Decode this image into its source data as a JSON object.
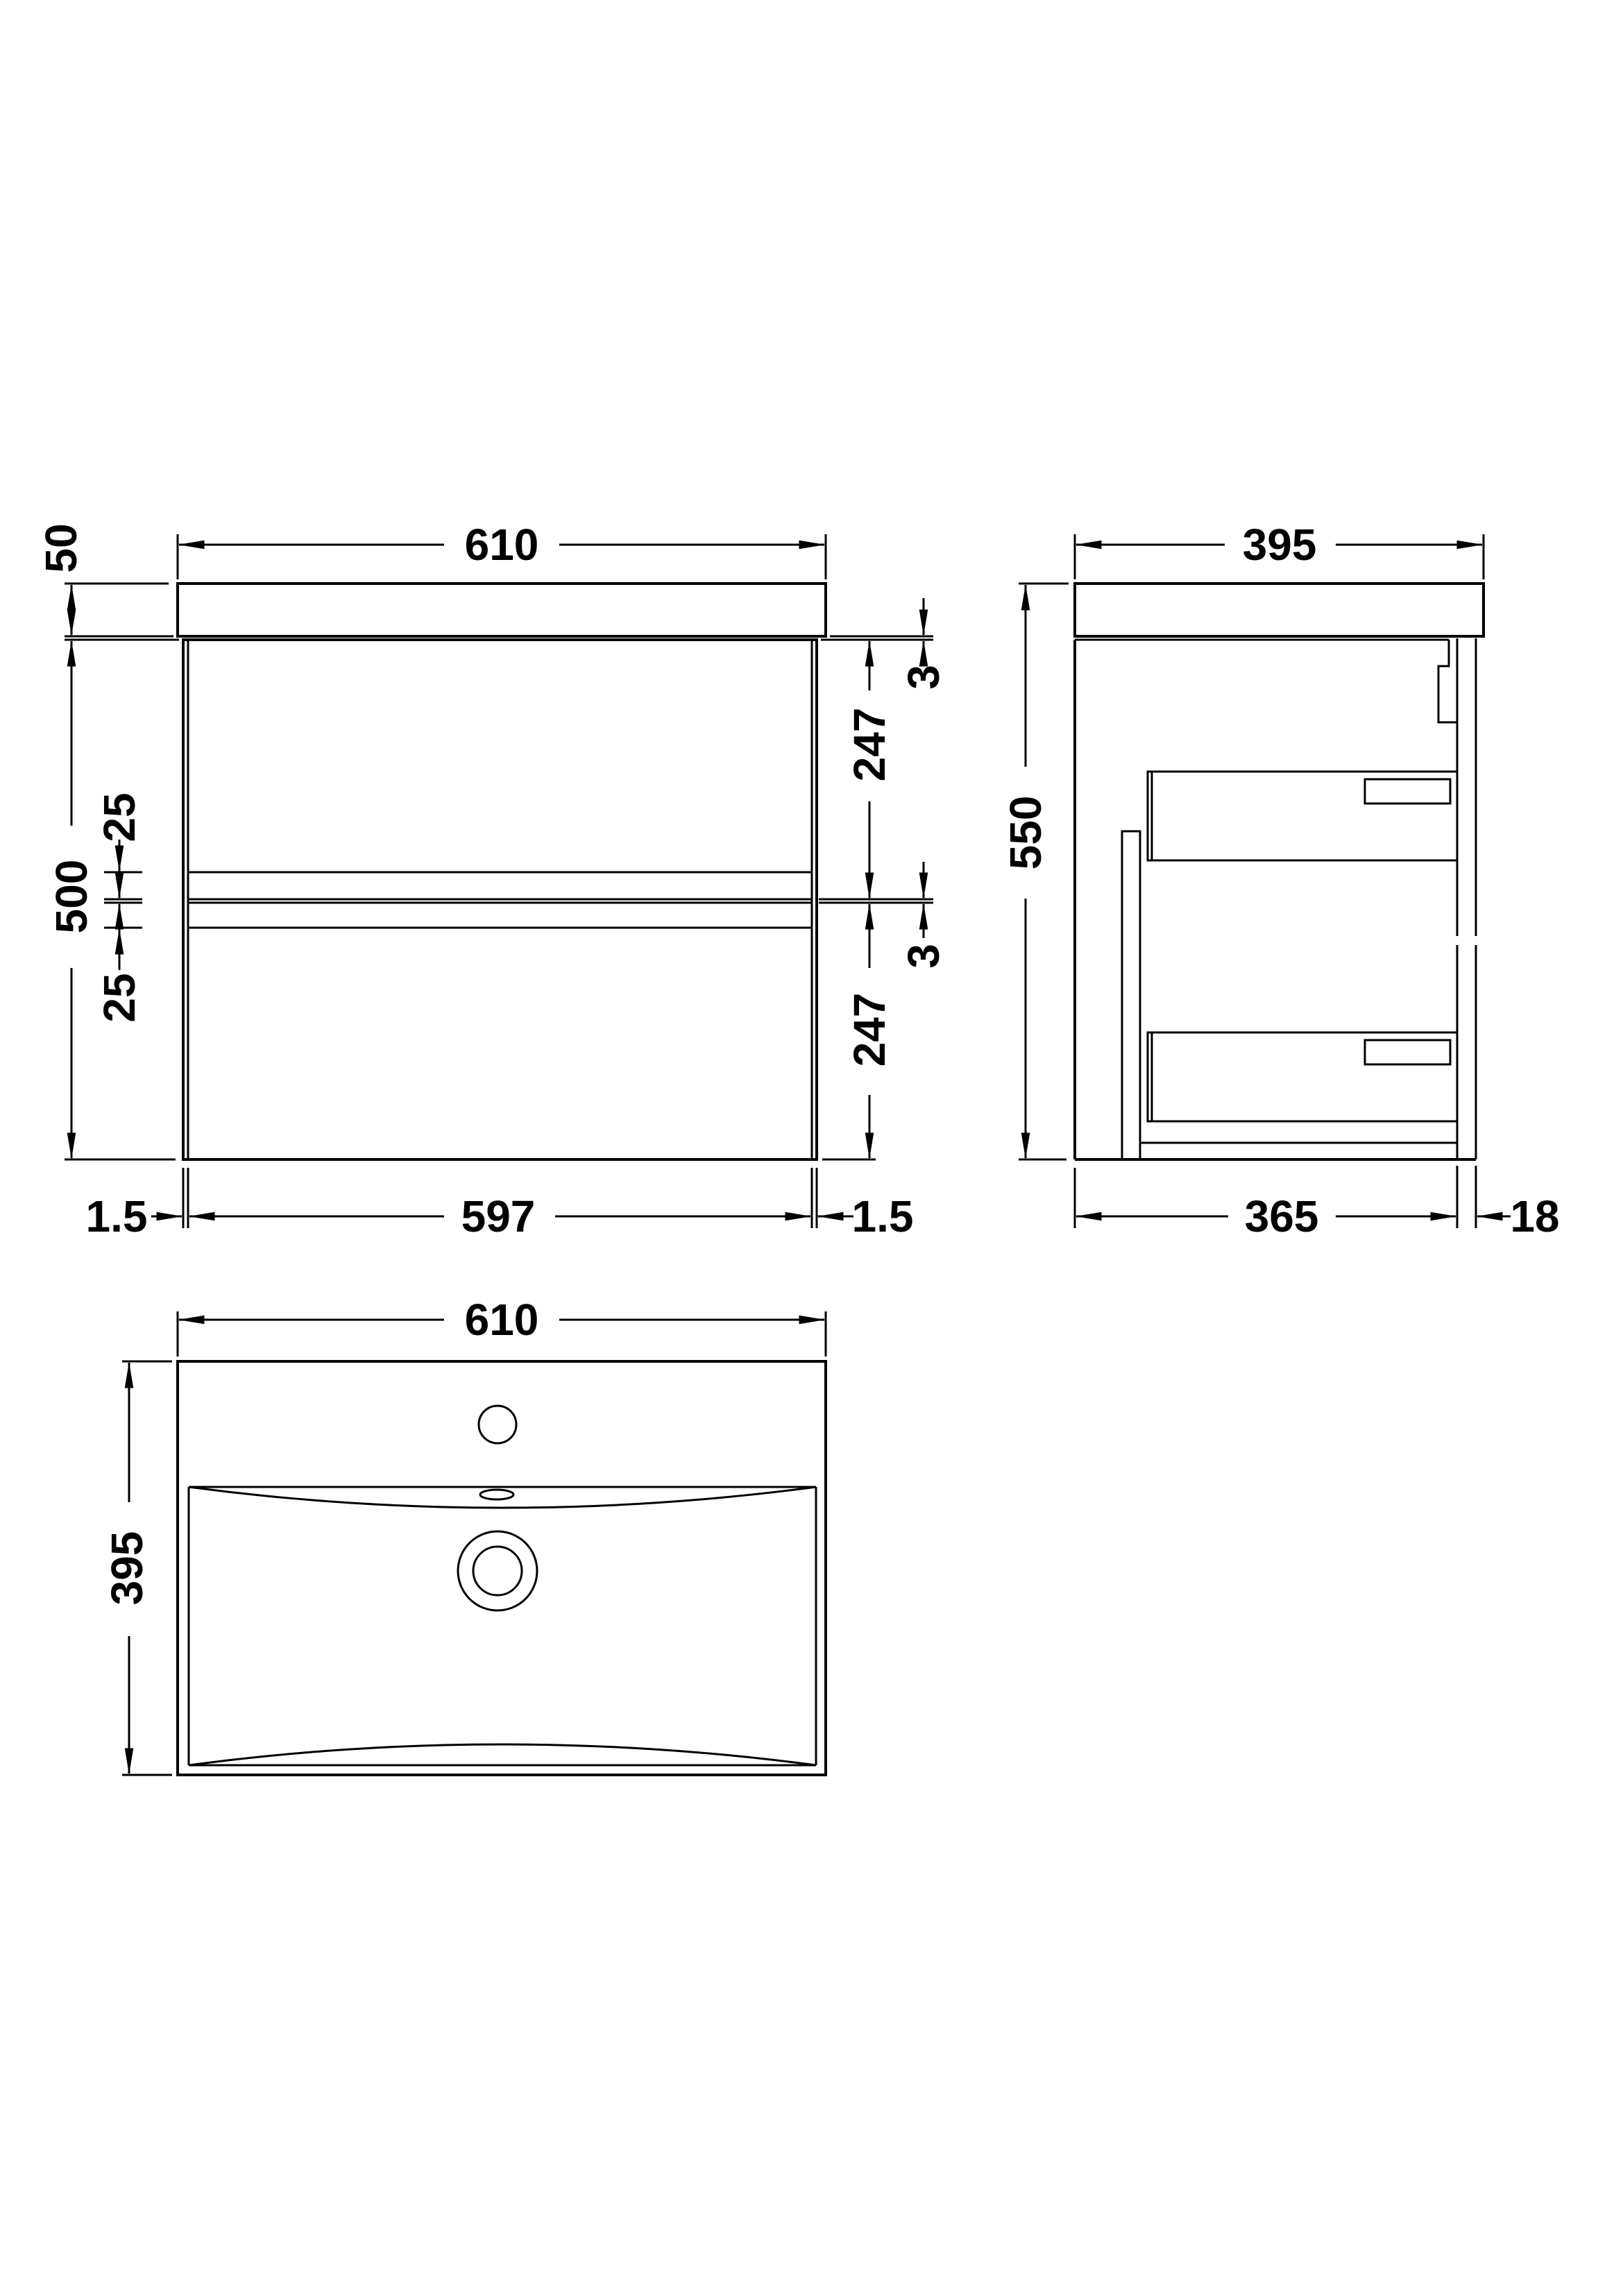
{
  "drawing_title": "wall-hung-vanity-unit-with-basin-technical-drawing",
  "colors": {
    "line": "#000000",
    "background": "#ffffff"
  },
  "views": {
    "front": {
      "dims": {
        "overall_width": "610",
        "worktop_thickness": "50",
        "cabinet_height": "500",
        "upper_gap": "25",
        "lower_gap": "25",
        "top_clearance": "3",
        "upper_drawer": "247",
        "mid_clearance": "3",
        "lower_drawer": "247",
        "left_gap": "1.5",
        "drawer_width": "597",
        "right_gap": "1.5"
      }
    },
    "side": {
      "dims": {
        "overall_depth": "395",
        "overall_height": "550",
        "cabinet_depth": "365",
        "back_rail": "18"
      }
    },
    "plan": {
      "dims": {
        "width": "610",
        "depth": "395"
      }
    }
  }
}
